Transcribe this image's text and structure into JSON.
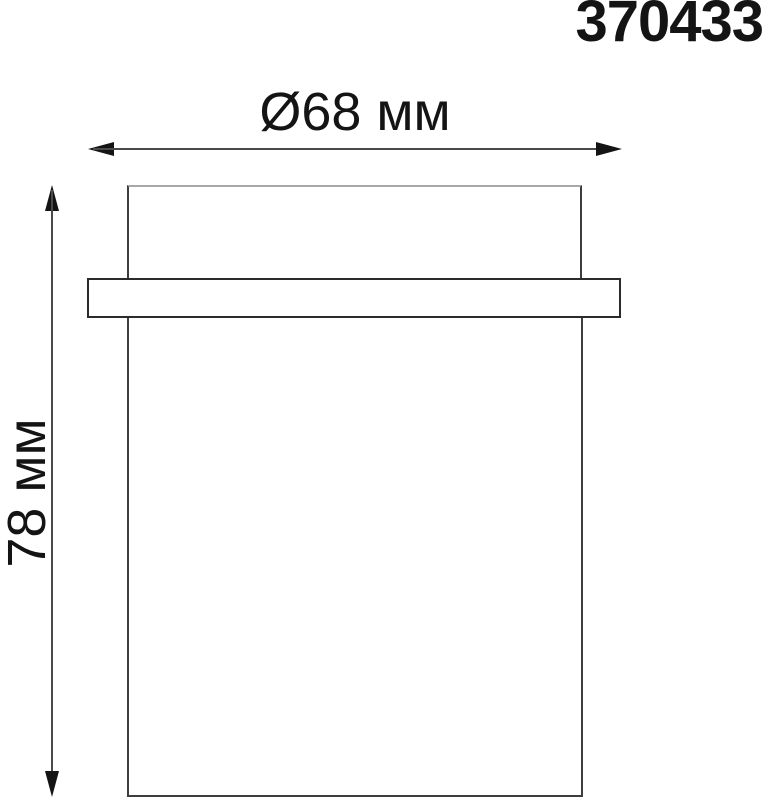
{
  "article_number": "370433",
  "drawing": {
    "type": "technical-dimension-diagram",
    "subject": "cylindrical spot light fixture, front elevation",
    "diameter_label": "Ø68 мм",
    "height_label": "78 мм",
    "diameter_value_mm": 68,
    "height_value_mm": 78
  },
  "colors": {
    "background": "#ffffff",
    "outline": "#3d3d3d",
    "dimension_line": "#4a4a4a",
    "text": "#141414"
  }
}
